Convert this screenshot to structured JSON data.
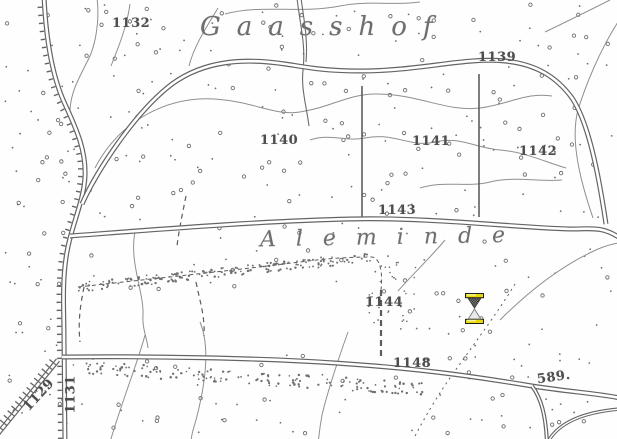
{
  "map": {
    "place_names": {
      "gaasshof": "Gaasshof",
      "aleminde": "Aleminde"
    },
    "labels": {
      "p1132": "1132",
      "p1139": "1139",
      "p1140": "1140",
      "p1141": "1141",
      "p1142": "1142",
      "p1143": "1143",
      "p1144": "1144",
      "p1148": "1148",
      "p589": "589.",
      "p1129": "1129",
      "p1131": "1131"
    },
    "features": {
      "roads": "double-line roads, left road with embankment tick hatching, bottom-left diagonal road with ladder hatching",
      "terrain": "heath/sand stipple dots, thin contour lines, dashed parcel boundaries, scrub dot bands"
    }
  },
  "cursor": {
    "name": "hourglass-wait-cursor"
  },
  "colors": {
    "background": "#fefefe",
    "road_line": "#646464",
    "contour_line": "#8f8f8f",
    "boundary_line": "#5d5d5d",
    "stipple": "#6f6f6f",
    "label_text": "#4d4d4d",
    "place_name_text": "#6e6e6e",
    "cursor_gold": "#e8d900",
    "cursor_outline": "#1f1f1f",
    "cursor_sand_dark": "#3c3c3c",
    "cursor_glass": "#e9e9e9"
  }
}
